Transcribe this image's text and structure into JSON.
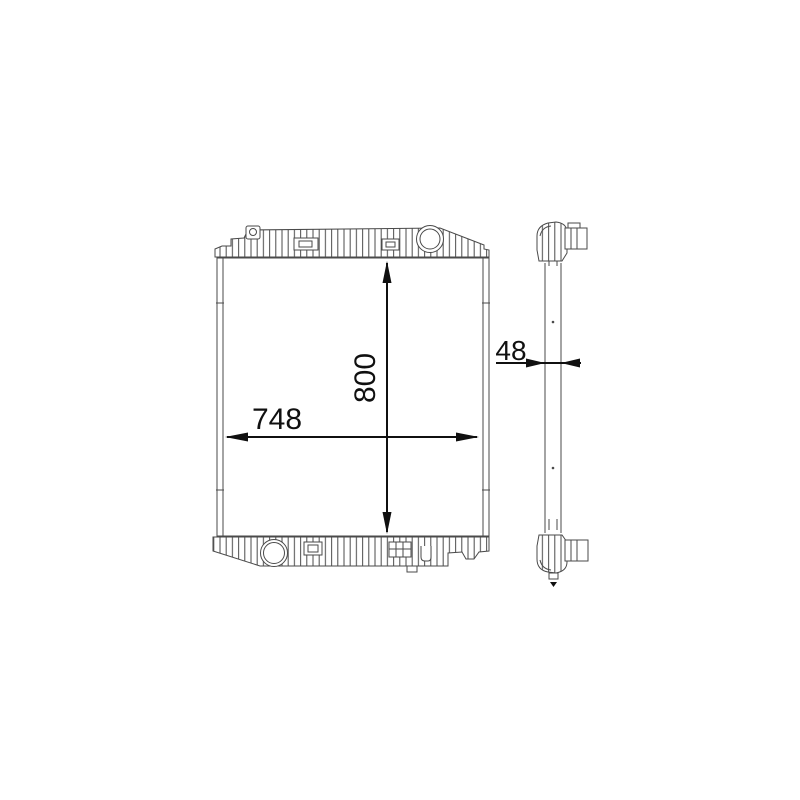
{
  "canvas": {
    "background": "#ffffff",
    "line_color": "#4a4a4a",
    "dimension_color": "#101010"
  },
  "dimensions": {
    "height_label": "800",
    "width_label": "748",
    "depth_label": "48"
  }
}
